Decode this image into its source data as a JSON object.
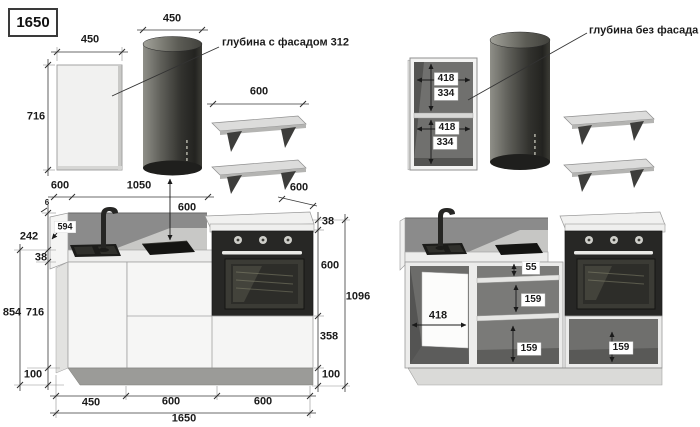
{
  "badge": {
    "total_width": "1650"
  },
  "colors": {
    "appliance_dark": "#272725",
    "cabinet_light": "#f4f4f3",
    "interior_gray": "#6f6f6d",
    "backsplash_gray": "#8b8b8b",
    "dimension_line": "#333333"
  },
  "left_view": {
    "note_depth_with_facade": "глубина с фасадом 312",
    "panel": {
      "width": "450",
      "height": "716"
    },
    "hood": {
      "width": "450",
      "distance_to_hob": "600"
    },
    "shelves": {
      "width": "600"
    },
    "top_dims": {
      "counter_depth": "600",
      "hood_axis": "1050",
      "depth_diagonal": "600"
    },
    "left_dims": {
      "reveal": "6",
      "inner_width": "594",
      "backsplash_height": "242",
      "counter_thickness": "38",
      "base_height": "854",
      "cabinet_height": "716",
      "plinth_height": "100"
    },
    "right_dims": {
      "counter_thickness": "38",
      "oven_height": "600",
      "drawer_height": "358",
      "plinth_height": "100",
      "total_height": "1096"
    },
    "bottom_dims": {
      "cabinet1": "450",
      "cabinet2": "600",
      "cabinet3": "600",
      "total": "1650"
    }
  },
  "right_view": {
    "note_depth_without_facade": "глубина без фасада 296",
    "wall_cabinet": {
      "top_width": "418",
      "top_height": "334",
      "bottom_width": "418",
      "bottom_height": "334"
    },
    "base": {
      "top_gap": "55",
      "shelf_gap_upper": "159",
      "shelf_gap_lower": "159",
      "sink_panel_width": "418",
      "oven_compartment": "159"
    }
  }
}
